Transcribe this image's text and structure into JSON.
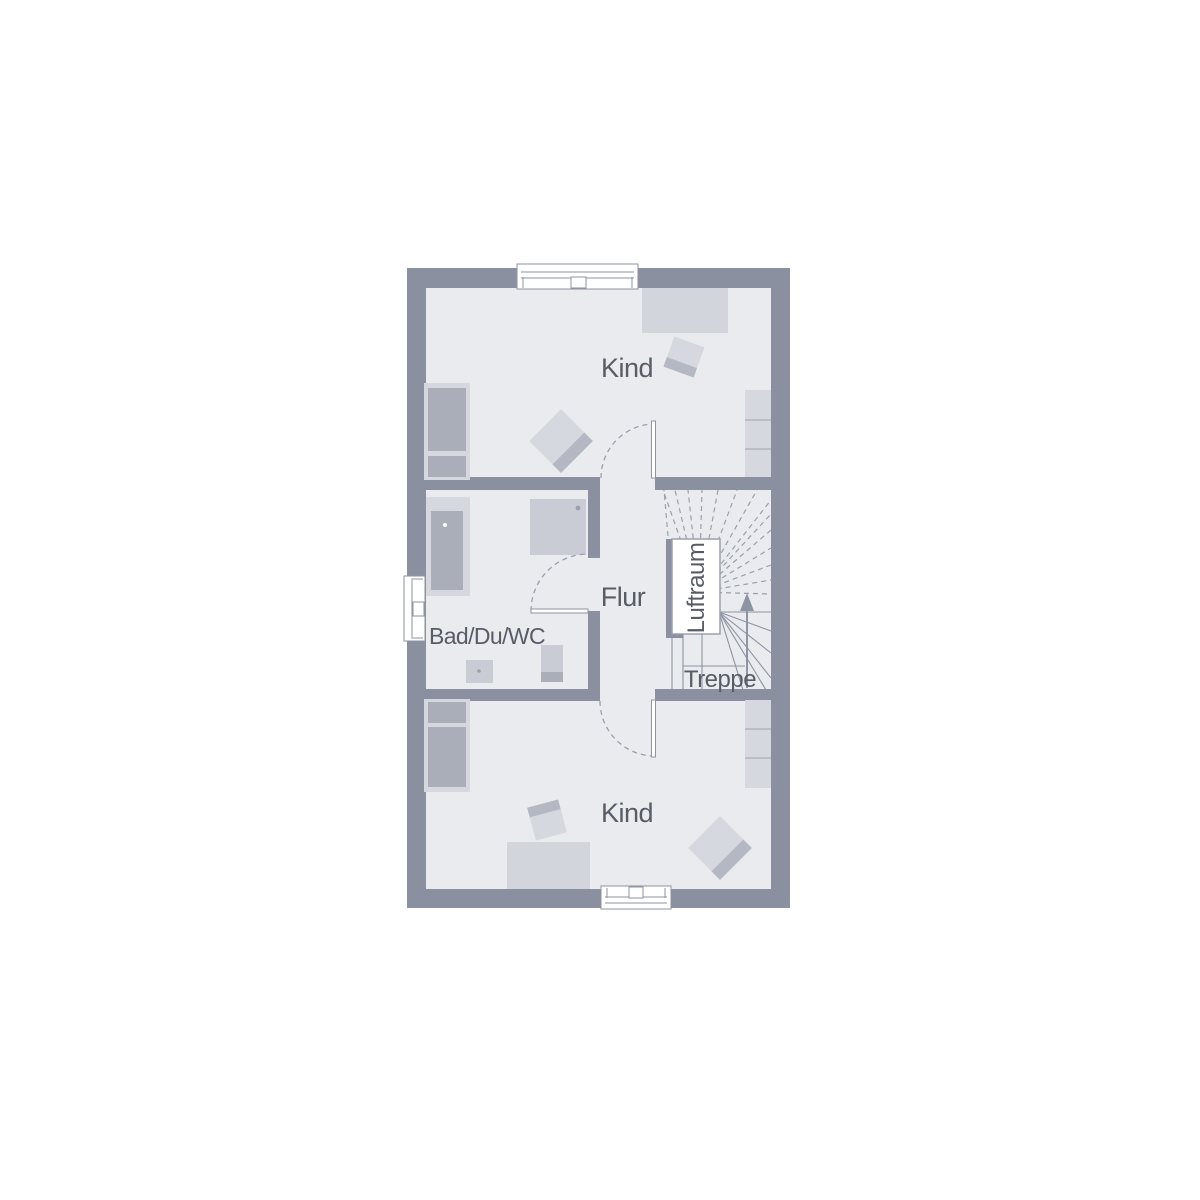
{
  "labels": {
    "kind_top": "Kind",
    "kind_bottom": "Kind",
    "bathroom": "Bad/Du/WC",
    "hallway": "Flur",
    "treppe": "Treppe",
    "luftraum": "Luftraum"
  },
  "colors": {
    "wall": "#8a90a0",
    "floor": "#e9ebee",
    "furniture_light": "#d5d8de",
    "furniture_mid": "#a9aeb9",
    "furniture_band": "#b3b8c2",
    "fixture": "#c9ccd4",
    "desk": "#d2d5dc",
    "cabinet_line": "#b0b5bf",
    "stair_line": "#8d94a2",
    "dash_line": "#9aa1ac",
    "label_text": "#575c67"
  }
}
